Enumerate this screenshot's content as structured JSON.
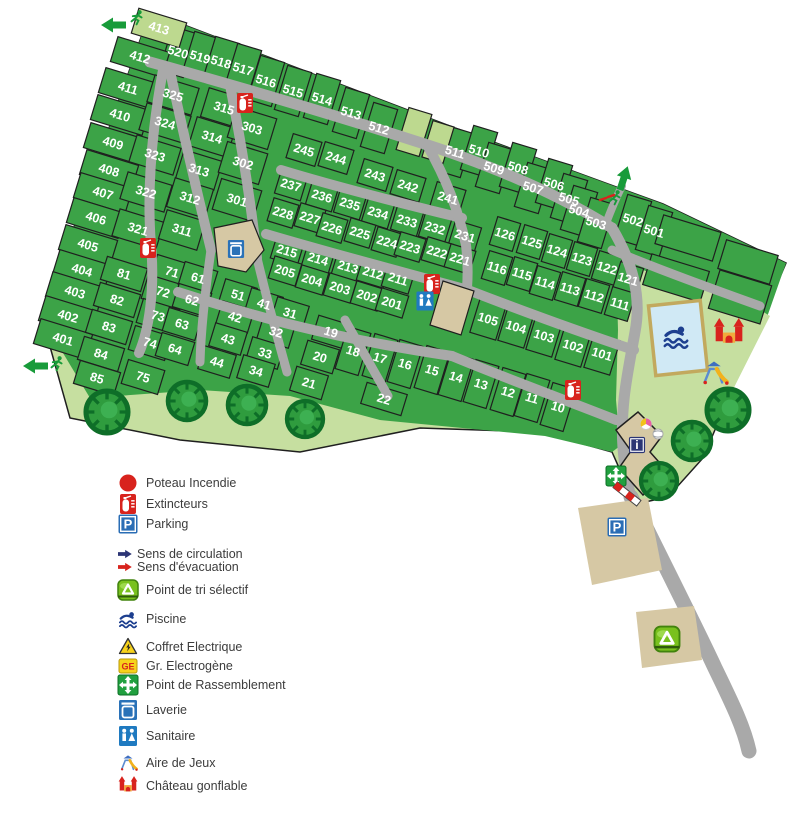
{
  "colors": {
    "plot_green": "#3ca347",
    "light_green": "#c6dfa0",
    "light_plot": "#bdd98f",
    "road": "#a9a9a9",
    "outline": "#1f1f1f",
    "tan": "#d6c8a4",
    "tree": "#2f9c3e",
    "tree_dark": "#0e6e28",
    "pool_water": "#d0e9f5",
    "pool_edge": "#c2a95e",
    "label": "#ffffff",
    "legend_text": "#3c3c3c",
    "red": "#d8231d",
    "blue": "#2a6db5",
    "navy": "#2c3575",
    "green_icon": "#21a03f",
    "yellow": "#f7d21b"
  },
  "icon_glyphs": {
    "parking": "P",
    "info": "i",
    "ge": "GE"
  },
  "legend": {
    "items": [
      {
        "icon": "hydrant",
        "label": "Poteau Incendie",
        "y": 487
      },
      {
        "icon": "extinguisher",
        "label": "Extincteurs",
        "y": 508
      },
      {
        "icon": "parking",
        "label": "Parking",
        "y": 528
      },
      {
        "icon": "arrow-circulation",
        "label": "Sens de circulation",
        "y": 558,
        "small": true,
        "color": "#2c3575"
      },
      {
        "icon": "arrow-evacuation",
        "label": "Sens d'évacuation",
        "y": 571,
        "small": true,
        "color": "#d8231d"
      },
      {
        "icon": "recycle",
        "label": "Point de tri sélectif",
        "y": 594
      },
      {
        "icon": "swimmer",
        "label": "Piscine",
        "y": 623
      },
      {
        "icon": "warning",
        "label": "Coffret Electrique",
        "y": 651
      },
      {
        "icon": "ge",
        "label": "Gr. Electrogène",
        "y": 670
      },
      {
        "icon": "assembly",
        "label": "Point de Rassemblement",
        "y": 689
      },
      {
        "icon": "laundry",
        "label": "Laverie",
        "y": 714
      },
      {
        "icon": "sanitary",
        "label": "Sanitaire",
        "y": 740
      },
      {
        "icon": "playground",
        "label": "Aire de Jeux",
        "y": 767
      },
      {
        "icon": "bouncy-castle",
        "label": "Château gonflable",
        "y": 790
      }
    ],
    "icon_x": 128,
    "label_x": 146
  },
  "map": {
    "rotation": 17,
    "groups": {
      "t5": {
        "w": 25,
        "h": 46
      },
      "w4": {
        "w": 54,
        "h": 26
      },
      "c32": {
        "w": 46,
        "h": 28
      },
      "c31": {
        "w": 40,
        "h": 30
      },
      "c30": {
        "w": 42,
        "h": 32
      },
      "r24": {
        "w": 30,
        "h": 25
      },
      "r23": {
        "w": 27,
        "h": 25
      },
      "r22": {
        "w": 26,
        "h": 24
      },
      "r21": {
        "w": 28,
        "h": 23
      },
      "r20": {
        "w": 28,
        "h": 23
      },
      "r12": {
        "w": 24,
        "h": 29
      },
      "r11": {
        "w": 24,
        "h": 29
      },
      "r10": {
        "w": 27,
        "h": 36
      },
      "c8": {
        "w": 42,
        "h": 24
      },
      "c7": {
        "w": 38,
        "h": 25
      },
      "c6": {
        "w": 34,
        "h": 24
      },
      "c45": {
        "w": 33,
        "h": 24
      },
      "tn": {
        "w": 24,
        "h": 44
      },
      "t19": {
        "w": 33,
        "h": 25
      },
      "w22": {
        "w": 42,
        "h": 22
      }
    },
    "plots": [
      [
        "520",
        178,
        52,
        "t5"
      ],
      [
        "519",
        200,
        57,
        "t5"
      ],
      [
        "518",
        221,
        62,
        "t5"
      ],
      [
        "517",
        243,
        69,
        "t5"
      ],
      [
        "516",
        266,
        81,
        "t5"
      ],
      [
        "515",
        293,
        91,
        "t5"
      ],
      [
        "514",
        322,
        99,
        "t5"
      ],
      [
        "513",
        351,
        113,
        "t5"
      ],
      [
        "512",
        379,
        128,
        "t5"
      ],
      [
        "511",
        455,
        152,
        "t5"
      ],
      [
        "510",
        479,
        151,
        "t5"
      ],
      [
        "509",
        494,
        168,
        "t5"
      ],
      [
        "508",
        518,
        168,
        "t5"
      ],
      [
        "507",
        533,
        188,
        "t5"
      ],
      [
        "506",
        554,
        184,
        "t5"
      ],
      [
        "505",
        569,
        199,
        "t5"
      ],
      [
        "504",
        579,
        211,
        "t5"
      ],
      [
        "503",
        596,
        223,
        "t5"
      ],
      [
        "502",
        633,
        220,
        "t5"
      ],
      [
        "501",
        654,
        231,
        "t5"
      ],
      [
        "412",
        140,
        57,
        "w4"
      ],
      [
        "411",
        128,
        88,
        "w4"
      ],
      [
        "410",
        120,
        115,
        "w4"
      ],
      [
        "409",
        113,
        143,
        "w4"
      ],
      [
        "408",
        109,
        170,
        "w4"
      ],
      [
        "407",
        103,
        193,
        "w4"
      ],
      [
        "406",
        96,
        218,
        "w4"
      ],
      [
        "405",
        88,
        245,
        "w4"
      ],
      [
        "404",
        82,
        270,
        "w4"
      ],
      [
        "403",
        75,
        292,
        "w4"
      ],
      [
        "402",
        68,
        316,
        "w4"
      ],
      [
        "401",
        63,
        339,
        "w4"
      ],
      [
        "325",
        173,
        95,
        "c32"
      ],
      [
        "324",
        165,
        123,
        "c32"
      ],
      [
        "323",
        155,
        155,
        "c32"
      ],
      [
        "322",
        146,
        192,
        "c32"
      ],
      [
        "321",
        138,
        229,
        "c32"
      ],
      [
        "315",
        224,
        108,
        "c31"
      ],
      [
        "314",
        212,
        137,
        "c31"
      ],
      [
        "313",
        199,
        170,
        "c31"
      ],
      [
        "312",
        190,
        198,
        "c31"
      ],
      [
        "311",
        182,
        230,
        "c31"
      ],
      [
        "303",
        252,
        128,
        "c30"
      ],
      [
        "302",
        243,
        163,
        "c30"
      ],
      [
        "301",
        237,
        200,
        "c30"
      ],
      [
        "245",
        304,
        150,
        "r24"
      ],
      [
        "244",
        336,
        158,
        "r24"
      ],
      [
        "243",
        375,
        175,
        "r24"
      ],
      [
        "242",
        408,
        186,
        "r24"
      ],
      [
        "241",
        448,
        198,
        "r24"
      ],
      [
        "237",
        291,
        185,
        "r23"
      ],
      [
        "236",
        322,
        196,
        "r23"
      ],
      [
        "235",
        350,
        204,
        "r23"
      ],
      [
        "234",
        378,
        213,
        "r23"
      ],
      [
        "233",
        407,
        221,
        "r23"
      ],
      [
        "232",
        435,
        228,
        "r23"
      ],
      [
        "231",
        465,
        236,
        "r23"
      ],
      [
        "228",
        283,
        213,
        "r22"
      ],
      [
        "227",
        310,
        218,
        "r22"
      ],
      [
        "226",
        332,
        228,
        "r22"
      ],
      [
        "225",
        360,
        233,
        "r22"
      ],
      [
        "224",
        387,
        242,
        "r22"
      ],
      [
        "223",
        410,
        247,
        "r22"
      ],
      [
        "222",
        437,
        252,
        "r22"
      ],
      [
        "221",
        460,
        259,
        "r22"
      ],
      [
        "215",
        287,
        251,
        "r21"
      ],
      [
        "214",
        318,
        259,
        "r21"
      ],
      [
        "213",
        348,
        267,
        "r21"
      ],
      [
        "212",
        373,
        273,
        "r21"
      ],
      [
        "211",
        398,
        279,
        "r21"
      ],
      [
        "205",
        285,
        271,
        "r20"
      ],
      [
        "204",
        312,
        280,
        "r20"
      ],
      [
        "203",
        340,
        288,
        "r20"
      ],
      [
        "202",
        367,
        296,
        "r20"
      ],
      [
        "201",
        392,
        303,
        "r20"
      ],
      [
        "126",
        505,
        234,
        "r12"
      ],
      [
        "125",
        532,
        242,
        "r12"
      ],
      [
        "124",
        557,
        251,
        "r12"
      ],
      [
        "123",
        582,
        259,
        "r12"
      ],
      [
        "122",
        607,
        268,
        "r12"
      ],
      [
        "121",
        628,
        279,
        "r12"
      ],
      [
        "116",
        497,
        268,
        "r11"
      ],
      [
        "115",
        522,
        274,
        "r11"
      ],
      [
        "114",
        545,
        283,
        "r11"
      ],
      [
        "113",
        570,
        289,
        "r11"
      ],
      [
        "112",
        594,
        296,
        "r11"
      ],
      [
        "111",
        620,
        304,
        "r11"
      ],
      [
        "105",
        488,
        319,
        "r10"
      ],
      [
        "104",
        516,
        327,
        "r10"
      ],
      [
        "103",
        544,
        336,
        "r10"
      ],
      [
        "102",
        573,
        346,
        "r10"
      ],
      [
        "101",
        602,
        354,
        "r10"
      ],
      [
        "81",
        124,
        274,
        "c8"
      ],
      [
        "82",
        117,
        300,
        "c8"
      ],
      [
        "83",
        109,
        327,
        "c8"
      ],
      [
        "84",
        101,
        354,
        "c8"
      ],
      [
        "85",
        97,
        378,
        "c8"
      ],
      [
        "71",
        172,
        272,
        "c7"
      ],
      [
        "72",
        163,
        292,
        "c7"
      ],
      [
        "73",
        158,
        316,
        "c7"
      ],
      [
        "74",
        150,
        343,
        "c7"
      ],
      [
        "75",
        143,
        377,
        "c7"
      ],
      [
        "61",
        198,
        278,
        "c6"
      ],
      [
        "62",
        192,
        300,
        "c6"
      ],
      [
        "63",
        182,
        324,
        "c6"
      ],
      [
        "64",
        175,
        349,
        "c6"
      ],
      [
        "51",
        238,
        295,
        "c45"
      ],
      [
        "41",
        264,
        304,
        "c45"
      ],
      [
        "42",
        235,
        317,
        "c45"
      ],
      [
        "31",
        290,
        313,
        "c45"
      ],
      [
        "32",
        276,
        332,
        "c45"
      ],
      [
        "43",
        228,
        339,
        "c45"
      ],
      [
        "33",
        265,
        353,
        "c45"
      ],
      [
        "44",
        217,
        362,
        "c45"
      ],
      [
        "34",
        256,
        371,
        "c45"
      ],
      [
        "19",
        331,
        332,
        "t19"
      ],
      [
        "20",
        320,
        357,
        "t19"
      ],
      [
        "21",
        309,
        383,
        "t19"
      ],
      [
        "22",
        384,
        399,
        "w22"
      ],
      [
        "18",
        353,
        351,
        "tn"
      ],
      [
        "17",
        380,
        358,
        "tn"
      ],
      [
        "16",
        405,
        364,
        "tn"
      ],
      [
        "15",
        432,
        370,
        "tn"
      ],
      [
        "14",
        456,
        377,
        "tn"
      ],
      [
        "13",
        481,
        384,
        "tn"
      ],
      [
        "12",
        508,
        392,
        "tn"
      ],
      [
        "11",
        532,
        398,
        "tn"
      ],
      [
        "10",
        558,
        407,
        "tn"
      ]
    ],
    "light_cells": [
      [
        "413",
        159,
        28,
        50,
        26
      ],
      [
        "",
        414,
        132,
        24,
        44
      ],
      [
        "",
        438,
        142,
        22,
        38
      ]
    ],
    "unnumbered": [
      [
        688,
        238,
        60,
        30
      ],
      [
        748,
        262,
        54,
        30
      ],
      [
        676,
        278,
        60,
        32
      ],
      [
        740,
        297,
        54,
        40
      ]
    ],
    "trees": [
      [
        107,
        412,
        21
      ],
      [
        187,
        401,
        19
      ],
      [
        247,
        405,
        19
      ],
      [
        305,
        419,
        18
      ],
      [
        728,
        410,
        21
      ],
      [
        692,
        441,
        19
      ],
      [
        659,
        481,
        18
      ]
    ],
    "icons": [
      [
        "extinguisher",
        245,
        103,
        1
      ],
      [
        "extinguisher",
        148,
        248,
        1
      ],
      [
        "extinguisher",
        432,
        284,
        1
      ],
      [
        "extinguisher",
        573,
        390,
        1
      ],
      [
        "sanitary",
        425,
        301,
        0.95
      ],
      [
        "laundry",
        236,
        249,
        0.9
      ],
      [
        "parking",
        617,
        527,
        1
      ],
      [
        "info",
        637,
        445,
        0.95
      ],
      [
        "assembly",
        616,
        476,
        1
      ],
      [
        "recycle",
        667,
        639,
        1.25
      ],
      [
        "swimmer",
        676,
        336,
        1.25
      ],
      [
        "bouncy-castle",
        729,
        334,
        1.45
      ],
      [
        "playground",
        714,
        373,
        1.35
      ],
      [
        "beach-ball",
        646,
        424,
        1
      ],
      [
        "volleyball",
        658,
        434,
        1
      ]
    ],
    "exits": [
      {
        "type": "evacuation-exit",
        "runner": [
          137,
          18
        ],
        "arrow": [
          126,
          25,
          180
        ],
        "color": "#189b3a"
      },
      {
        "type": "evacuation-exit",
        "runner": [
          57,
          364
        ],
        "arrow": [
          48,
          366,
          180
        ],
        "color": "#189b3a"
      },
      {
        "type": "circulation-exit",
        "runner": [
          615,
          198
        ],
        "arrow": [
          620,
          190,
          -72
        ],
        "color": "#189b3a",
        "dashes": true
      }
    ],
    "barrier": [
      627,
      494,
      38
    ]
  }
}
